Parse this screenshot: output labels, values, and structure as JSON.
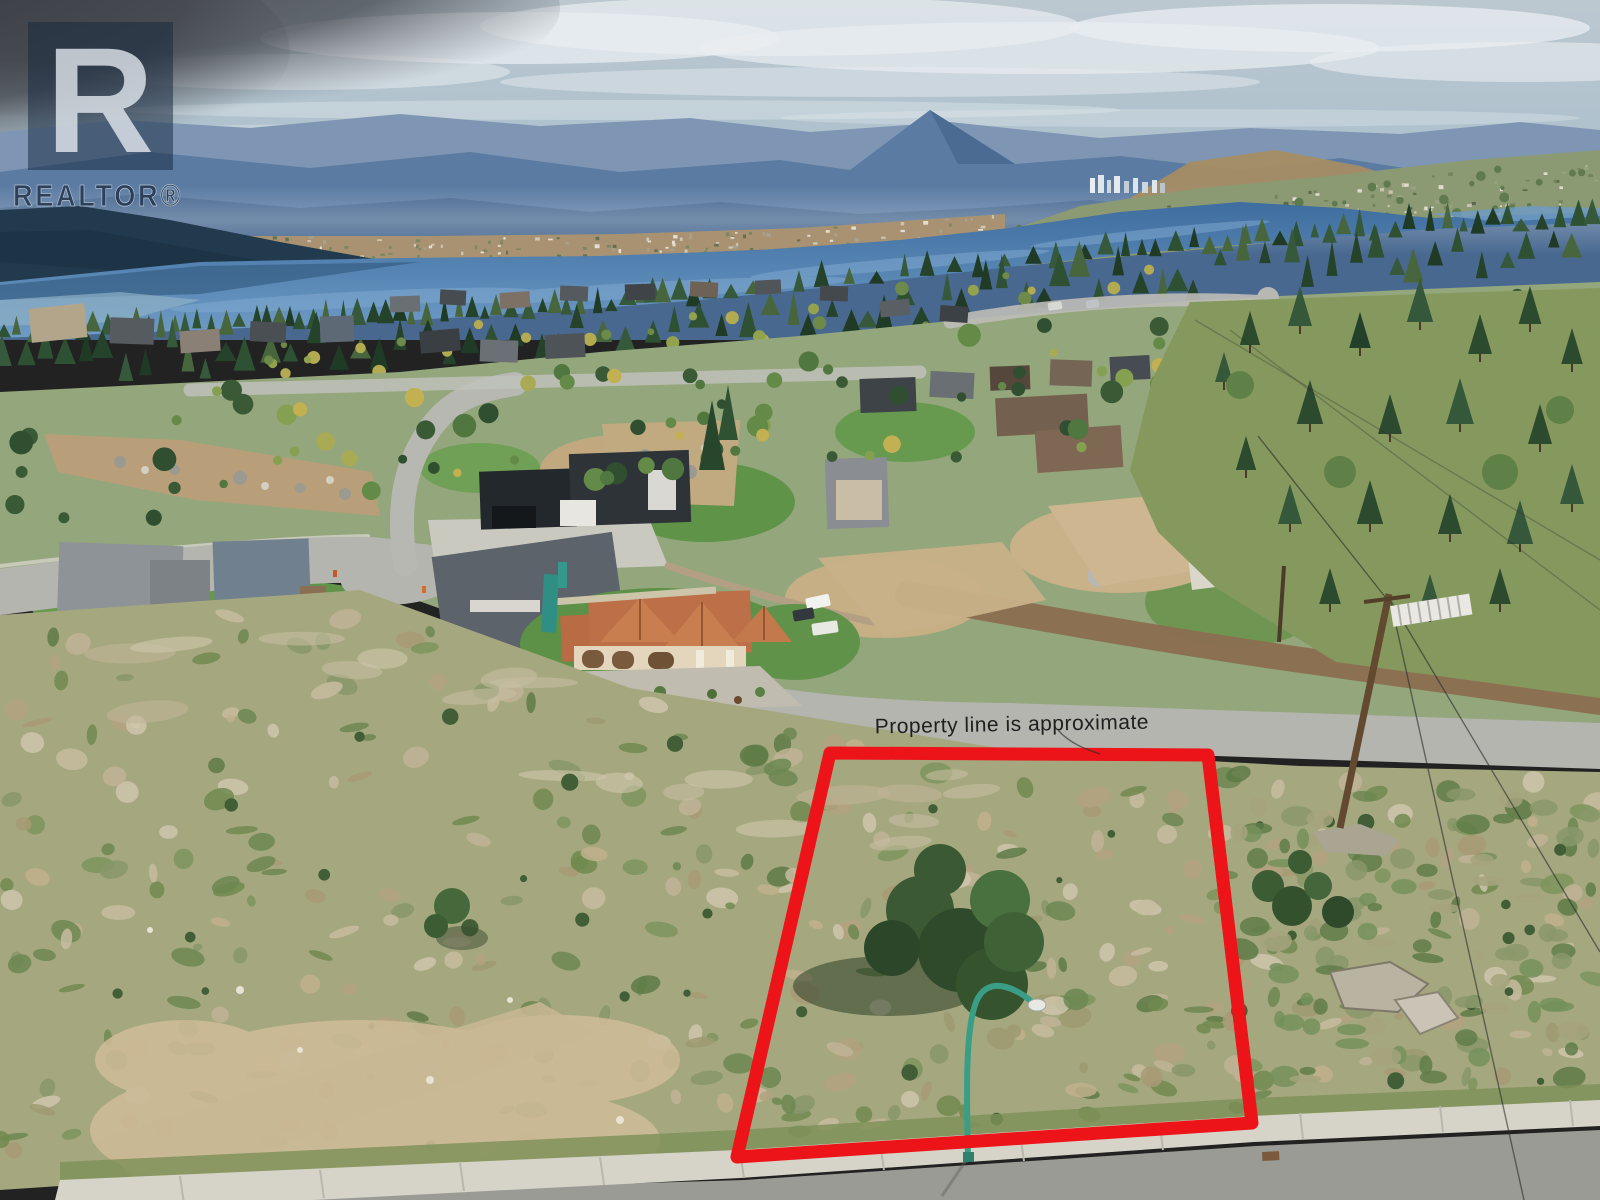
{
  "meta": {
    "alt": "Aerial drone photo of a vacant hillside building lot outlined in red, above a lakeside suburban neighbourhood with mountains and a large lake in the distance"
  },
  "watermark": {
    "logo_letter": "R",
    "label": "REALTOR®"
  },
  "annotation": {
    "text": "Property line is approximate",
    "color": "#1f1f1f"
  },
  "property_outline": {
    "points": "830,753 1208,755 1252,1123 737,1157",
    "color": "#ec1419",
    "stroke_width": "13"
  },
  "palette": {
    "watermark_navy": "#17293f",
    "watermark_text": "#24364f",
    "lamp_teal": "#3a9e86",
    "lake_blue": "#4b7dae",
    "road_gray": "#b4b5af",
    "dirt_brown": "#8a6e50"
  }
}
